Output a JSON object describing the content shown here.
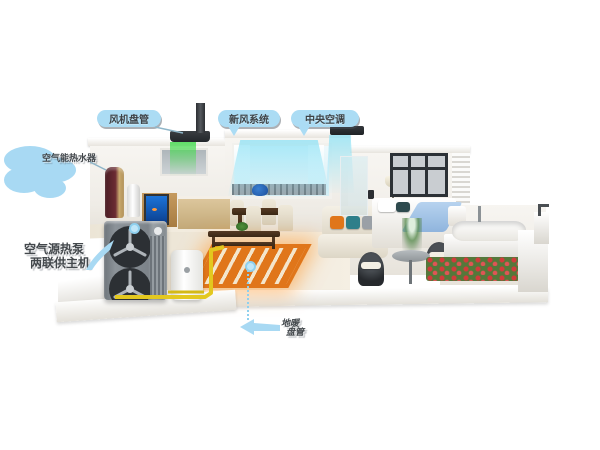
{
  "scene_title": "air-source-heat-pump-home-cutaway",
  "callouts": {
    "fan_coil": {
      "text": "风机盘管"
    },
    "fresh_air": {
      "text": "新风系统"
    },
    "central_ac": {
      "text": "中央空调"
    },
    "water_heater": {
      "text": "空气能热水器"
    },
    "heat_pump": {
      "line1": "空气源热泵",
      "line2": "两联供主机"
    },
    "floor_heating": {
      "line1": "地暖",
      "line2": "盘管"
    }
  },
  "colors": {
    "callout_blue": "#abdcf4",
    "callout_text": "#43484c",
    "floor_heating_orange": "#e0761a",
    "pipe_yellow": "#e3c81f",
    "fresh_air_green": "#46dc50",
    "cool_air_cyan": "#8ce1f5",
    "heat_pump_gray": "#7d848a",
    "water_heater_wine": "#6b2b33",
    "duvet_blue": "#9fc3e8"
  },
  "objects": [
    "outdoor-heat-pump-unit",
    "buffer-water-tank",
    "yellow-piping",
    "water-heater-cylinder",
    "kitchen-range-hood",
    "ceiling-fan-coil",
    "living-room-window-air-curtain",
    "floor-heating-rug",
    "dining-set",
    "sofa",
    "bed",
    "bathtub",
    "terrace-flowers"
  ]
}
